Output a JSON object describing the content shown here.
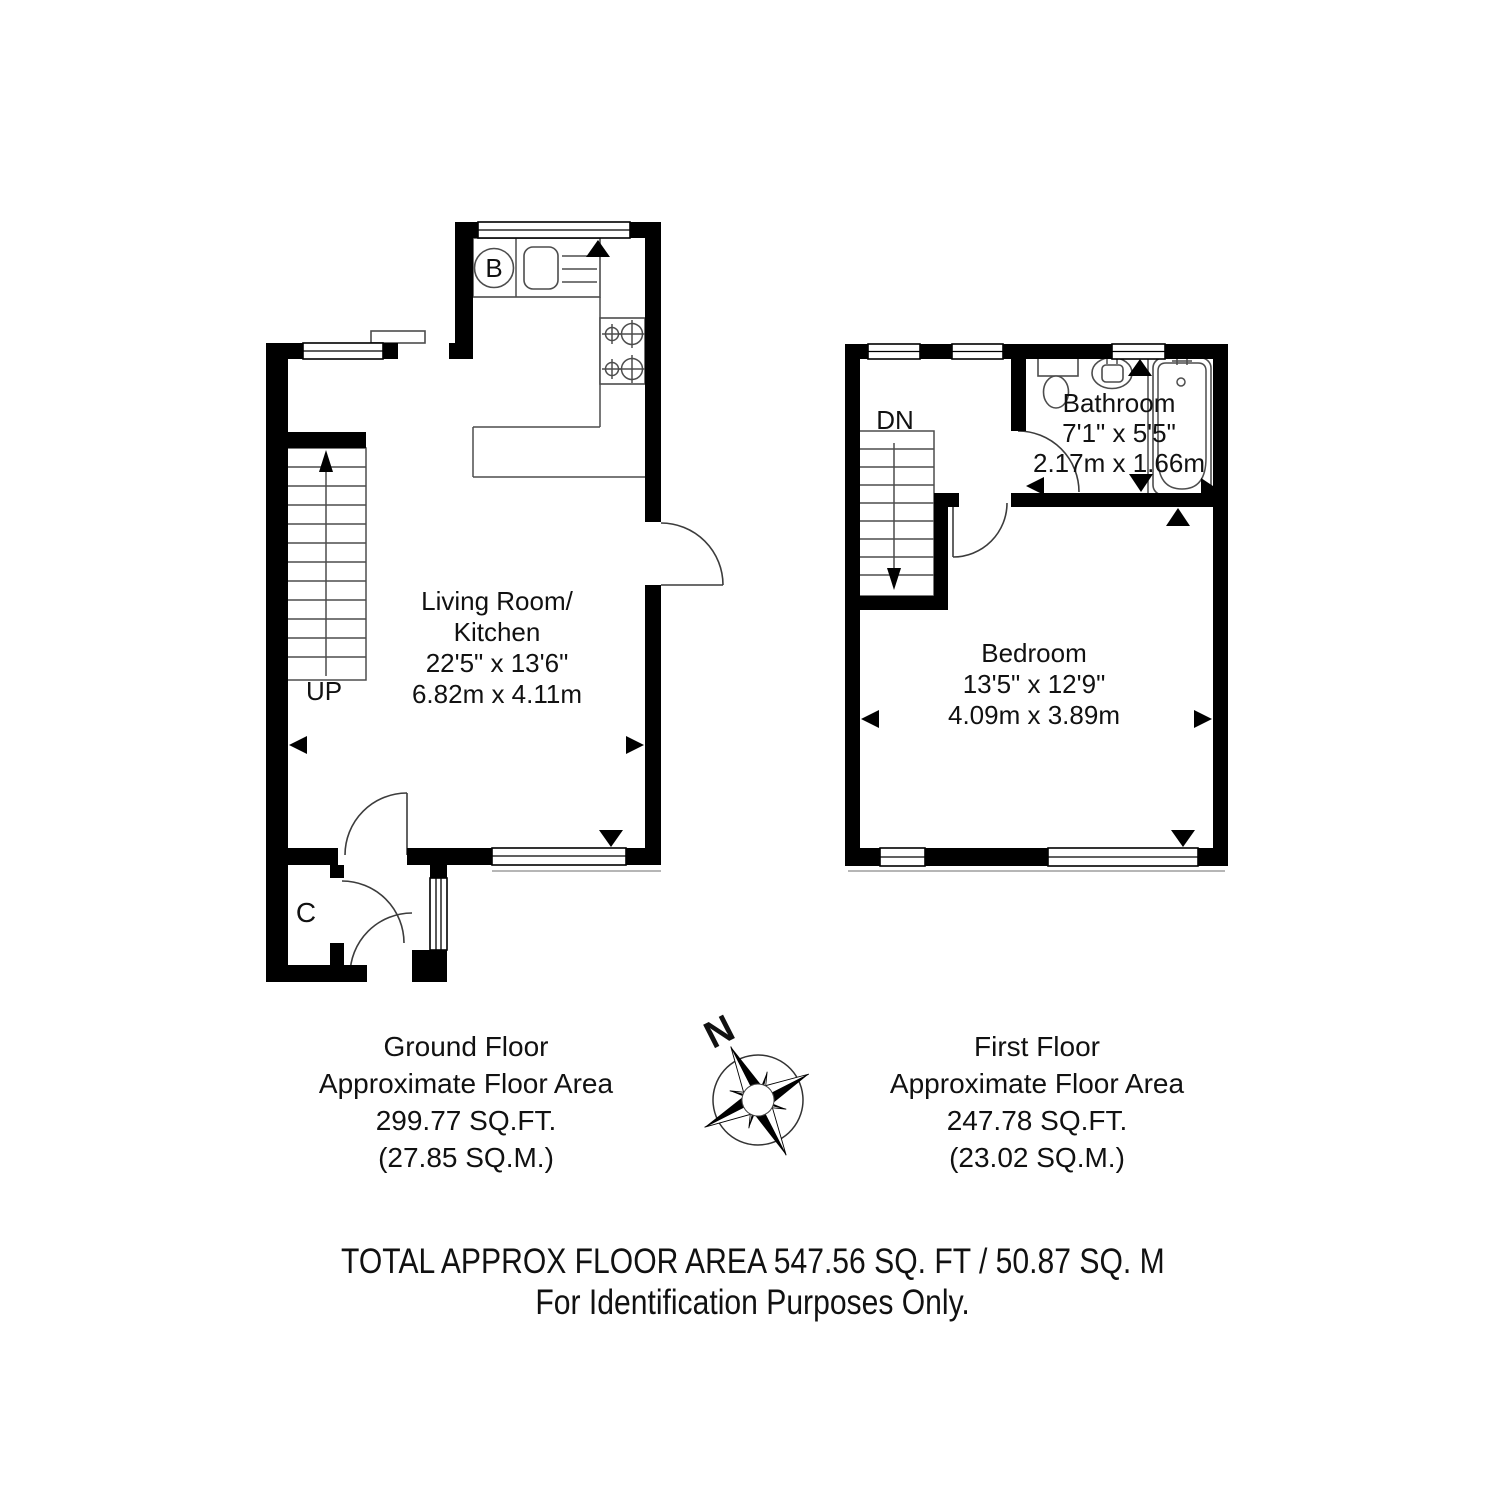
{
  "ground_floor": {
    "room": {
      "name_line1": "Living Room/",
      "name_line2": "Kitchen",
      "dim_imperial": "22'5\" x 13'6\"",
      "dim_metric": "6.82m x 4.11m"
    },
    "stairs_label": "UP",
    "boiler_label": "B",
    "cupboard_label": "C",
    "caption": [
      "Ground Floor",
      "Approximate Floor Area",
      "299.77 SQ.FT.",
      "(27.85 SQ.M.)"
    ]
  },
  "first_floor": {
    "bathroom": {
      "name": "Bathroom",
      "dim_imperial": "7'1\" x 5'5\"",
      "dim_metric": "2.17m x 1.66m"
    },
    "bedroom": {
      "name": "Bedroom",
      "dim_imperial": "13'5\" x 12'9\"",
      "dim_metric": "4.09m x 3.89m"
    },
    "stairs_label": "DN",
    "caption": [
      "First Floor",
      "Approximate Floor Area",
      "247.78 SQ.FT.",
      "(23.02 SQ.M.)"
    ]
  },
  "compass": {
    "north_label": "N"
  },
  "footer": {
    "line1": "TOTAL APPROX FLOOR AREA 547.56 SQ. FT / 50.87 SQ. M",
    "line2": "For Identification Purposes Only."
  },
  "colors": {
    "wall": "#000000",
    "line": "#4d4d4d",
    "text": "#111111"
  }
}
